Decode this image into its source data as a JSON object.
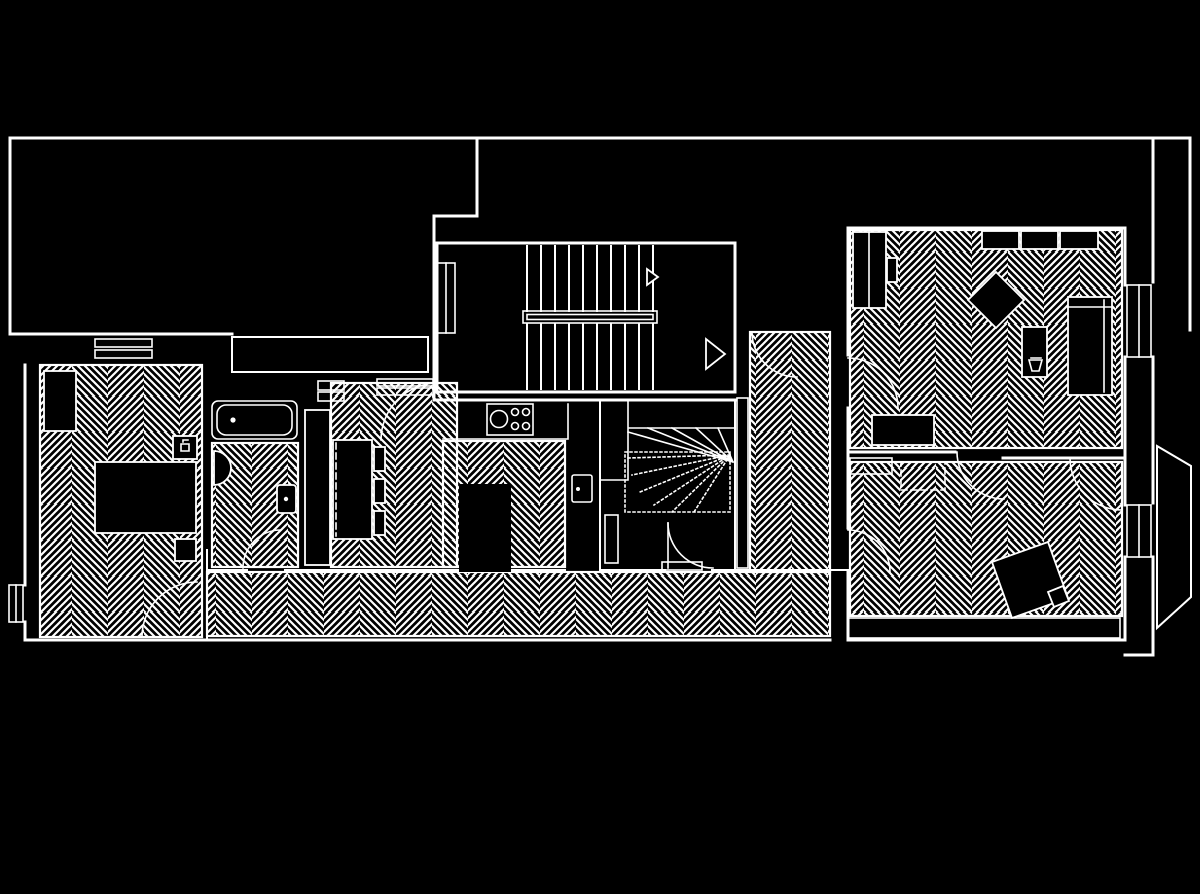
{
  "canvas": {
    "width": 1200,
    "height": 894,
    "background_color": "#000000",
    "line_color": "#ffffff",
    "drawing_type": "architectural floor plan, white-on-black CAD line drawing",
    "floor_finish_hatch": "herringbone parquet"
  },
  "labels": {
    "plan": "floor-plan",
    "left_room": "room-left-bedroom",
    "bathroom": "bathroom",
    "middle_room": "room-middle-living",
    "kitchen": "kitchen",
    "stair_hall": "main-staircase-hall",
    "winder_stair": "winder-staircase",
    "hall_right": "hallway-right",
    "corridor": "bottom-corridor",
    "right_top_room": "room-right-top",
    "right_bottom_room": "room-right-bottom",
    "bay": "exterior-stepped-bay",
    "bathtub": "bathtub",
    "washbasin": "washbasin",
    "toilet": "toilet",
    "cooktop": "cooktop",
    "island": "kitchen-island",
    "bed": "bed",
    "sofa": "sofa",
    "wardrobe": "wardrobe",
    "sideboard": "sideboard",
    "diamond_table": "rotated-square-table",
    "armchair": "rotated-armchair",
    "bookshelf": "bookshelf-with-books",
    "desk": "desk",
    "stripe_band": "striped-deck-band",
    "window": "window",
    "door_arc": "door-swing-arc",
    "direction_arrow": "stair-direction-arrow"
  },
  "stairs": {
    "main": {
      "upper_flight_treads": 10,
      "lower_flight_treads": 10,
      "center_rail": true,
      "arrows": 2
    },
    "winder": {
      "solid_rays": 5,
      "dashed_rays": 6,
      "dashed_landing_outline": true
    }
  },
  "fixtures_inventory": {
    "left_room": [
      "wardrobe",
      "bed",
      "side-table",
      "small-table",
      "window-top",
      "window-left",
      "door"
    ],
    "bathroom": [
      "bathtub",
      "washbasin",
      "toilet",
      "door"
    ],
    "middle_room": [
      "tall-cabinet",
      "sofa",
      "cushions",
      "door"
    ],
    "kitchen": [
      "counter",
      "cooktop",
      "island",
      "wall-appliance"
    ],
    "right_top_room": [
      "wardrobe",
      "sideboard-3-sections",
      "rotated-square-table",
      "small-table-with-cup",
      "bed",
      "desk"
    ],
    "right_bottom_room": [
      "radiator-shelf",
      "dashed-table",
      "rotated-armchair",
      "small-stool",
      "bookshelf-row"
    ],
    "exterior": [
      "stepped-bay",
      "striped-deck-band"
    ]
  }
}
